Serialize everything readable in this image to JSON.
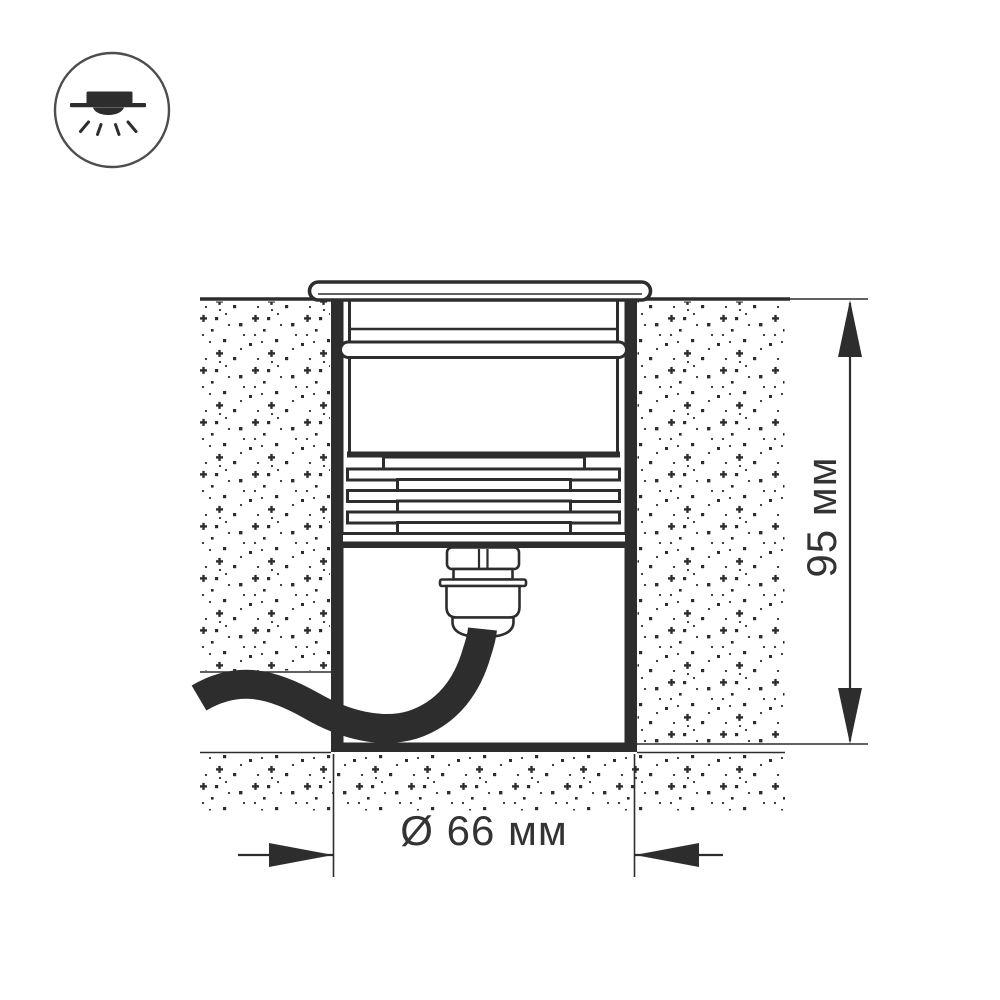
{
  "icon": {
    "name": "recessed-downlight-icon"
  },
  "diagram": {
    "dimension_height": "95 мм",
    "dimension_diameter": "Ø 66 мм"
  },
  "colors": {
    "line": "#2d2d2d",
    "text": "#333333",
    "icon_circle": "#4d4d4d",
    "background": "#ffffff"
  }
}
